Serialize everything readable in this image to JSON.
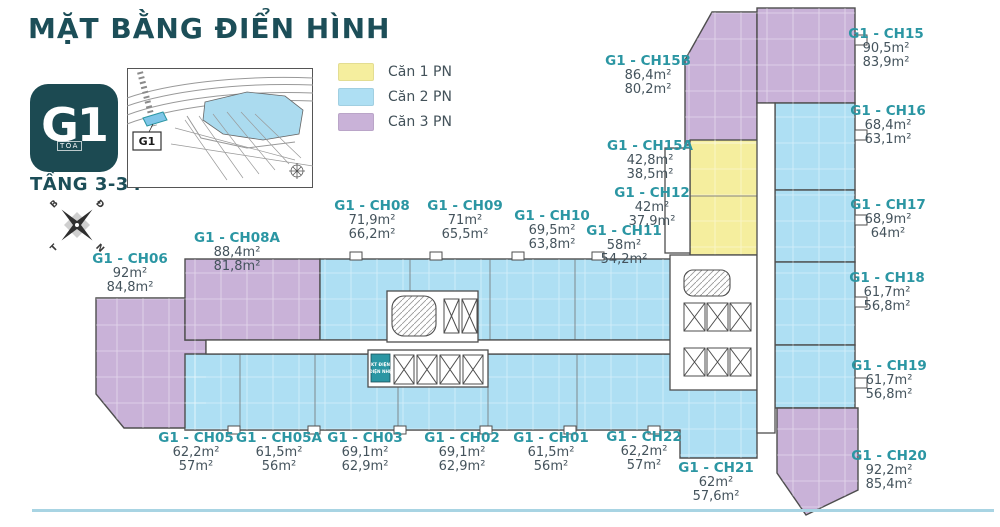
{
  "header": {
    "title": "MẶT BẰNG ĐIỂN HÌNH",
    "badge_code": "G1",
    "badge_label": "TÒA",
    "floor_range": "TẦNG 3-34"
  },
  "legend": {
    "items": [
      {
        "label": "Căn 1 PN",
        "type": "1PN",
        "color": "#F5EE9E"
      },
      {
        "label": "Căn 2 PN",
        "type": "2PN",
        "color": "#AEDFF3"
      },
      {
        "label": "Căn 3 PN",
        "type": "3PN",
        "color": "#C9B2D8"
      }
    ]
  },
  "compass": {
    "top_left": "B",
    "top_right": "Đ",
    "bottom_left": "T",
    "bottom_right": "N"
  },
  "site_map": {
    "building_label": "G1"
  },
  "plan": {
    "technical_room": {
      "line1": "KT ĐIỆN",
      "line2": "ĐIỆN NHẸ"
    },
    "units": [
      {
        "id": "CH06",
        "name": "G1 - CH06",
        "area1": "92m²",
        "area2": "84,8m²",
        "type": "3PN",
        "x": 130,
        "y": 252
      },
      {
        "id": "CH08A",
        "name": "G1 - CH08A",
        "area1": "88,4m²",
        "area2": "81,8m²",
        "type": "3PN",
        "x": 237,
        "y": 231
      },
      {
        "id": "CH08",
        "name": "G1 - CH08",
        "area1": "71,9m²",
        "area2": "66,2m²",
        "type": "2PN",
        "x": 372,
        "y": 199
      },
      {
        "id": "CH09",
        "name": "G1 - CH09",
        "area1": "71m²",
        "area2": "65,5m²",
        "type": "2PN",
        "x": 465,
        "y": 199
      },
      {
        "id": "CH10",
        "name": "G1 - CH10",
        "area1": "69,5m²",
        "area2": "63,8m²",
        "type": "2PN",
        "x": 552,
        "y": 209
      },
      {
        "id": "CH11",
        "name": "G1 - CH11",
        "area1": "58m²",
        "area2": "54,2m²",
        "type": "2PN",
        "x": 624,
        "y": 224
      },
      {
        "id": "CH15B",
        "name": "G1 - CH15B",
        "area1": "86,4m²",
        "area2": "80,2m²",
        "type": "3PN",
        "x": 648,
        "y": 54
      },
      {
        "id": "CH15A",
        "name": "G1 - CH15A",
        "area1": "42,8m²",
        "area2": "38,5m²",
        "type": "1PN",
        "x": 650,
        "y": 139
      },
      {
        "id": "CH12",
        "name": "G1 - CH12",
        "area1": "42m²",
        "area2": "37,9m²",
        "type": "1PN",
        "x": 652,
        "y": 186
      },
      {
        "id": "CH15",
        "name": "G1 - CH15",
        "area1": "90,5m²",
        "area2": "83,9m²",
        "type": "3PN",
        "x": 886,
        "y": 27
      },
      {
        "id": "CH16",
        "name": "G1 - CH16",
        "area1": "68,4m²",
        "area2": "63,1m²",
        "type": "2PN",
        "x": 888,
        "y": 104
      },
      {
        "id": "CH17",
        "name": "G1 - CH17",
        "area1": "68,9m²",
        "area2": "64m²",
        "type": "2PN",
        "x": 888,
        "y": 198
      },
      {
        "id": "CH18",
        "name": "G1 - CH18",
        "area1": "61,7m²",
        "area2": "56,8m²",
        "type": "2PN",
        "x": 887,
        "y": 271
      },
      {
        "id": "CH19",
        "name": "G1 - CH19",
        "area1": "61,7m²",
        "area2": "56,8m²",
        "type": "2PN",
        "x": 889,
        "y": 359
      },
      {
        "id": "CH20",
        "name": "G1 - CH20",
        "area1": "92,2m²",
        "area2": "85,4m²",
        "type": "3PN",
        "x": 889,
        "y": 449
      },
      {
        "id": "CH21",
        "name": "G1 - CH21",
        "area1": "62m²",
        "area2": "57,6m²",
        "type": "2PN",
        "x": 716,
        "y": 461
      },
      {
        "id": "CH05",
        "name": "G1 - CH05",
        "area1": "62,2m²",
        "area2": "57m²",
        "type": "2PN",
        "x": 196,
        "y": 431
      },
      {
        "id": "CH05A",
        "name": "G1 - CH05A",
        "area1": "61,5m²",
        "area2": "56m²",
        "type": "2PN",
        "x": 279,
        "y": 431
      },
      {
        "id": "CH03",
        "name": "G1 - CH03",
        "area1": "69,1m²",
        "area2": "62,9m²",
        "type": "2PN",
        "x": 365,
        "y": 431
      },
      {
        "id": "CH02",
        "name": "G1 - CH02",
        "area1": "69,1m²",
        "area2": "62,9m²",
        "type": "2PN",
        "x": 462,
        "y": 431
      },
      {
        "id": "CH01",
        "name": "G1 - CH01",
        "area1": "61,5m²",
        "area2": "56m²",
        "type": "2PN",
        "x": 551,
        "y": 431
      },
      {
        "id": "CH22",
        "name": "G1 - CH22",
        "area1": "62,2m²",
        "area2": "57m²",
        "type": "2PN",
        "x": 644,
        "y": 430
      }
    ]
  }
}
